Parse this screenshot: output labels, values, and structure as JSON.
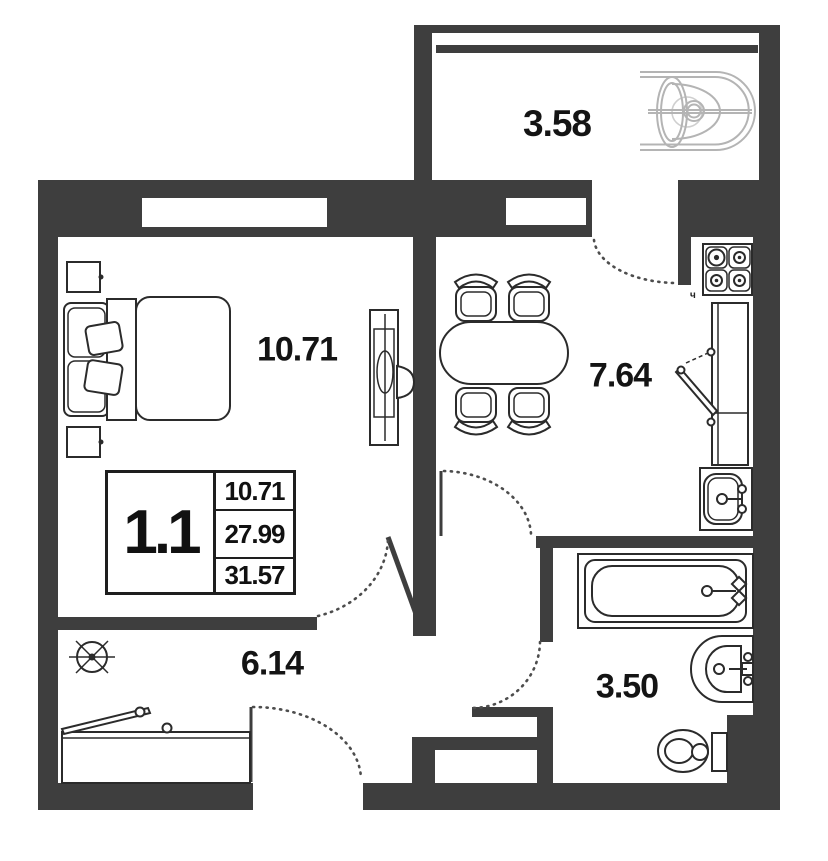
{
  "plan": {
    "legend": {
      "unit": "1.1",
      "values": [
        "10.71",
        "27.99",
        "31.57"
      ]
    },
    "rooms": {
      "balcony": "3.58",
      "bedroom": "10.71",
      "kitchen": "7.64",
      "hallway": "6.14",
      "bathroom": "3.50"
    },
    "stove_mark": "ч"
  },
  "colors": {
    "wall": "#3e3e3e",
    "line": "#2b2b2b",
    "furniture_light": "#b4b4b4",
    "text": "#141414",
    "background": "#ffffff"
  }
}
